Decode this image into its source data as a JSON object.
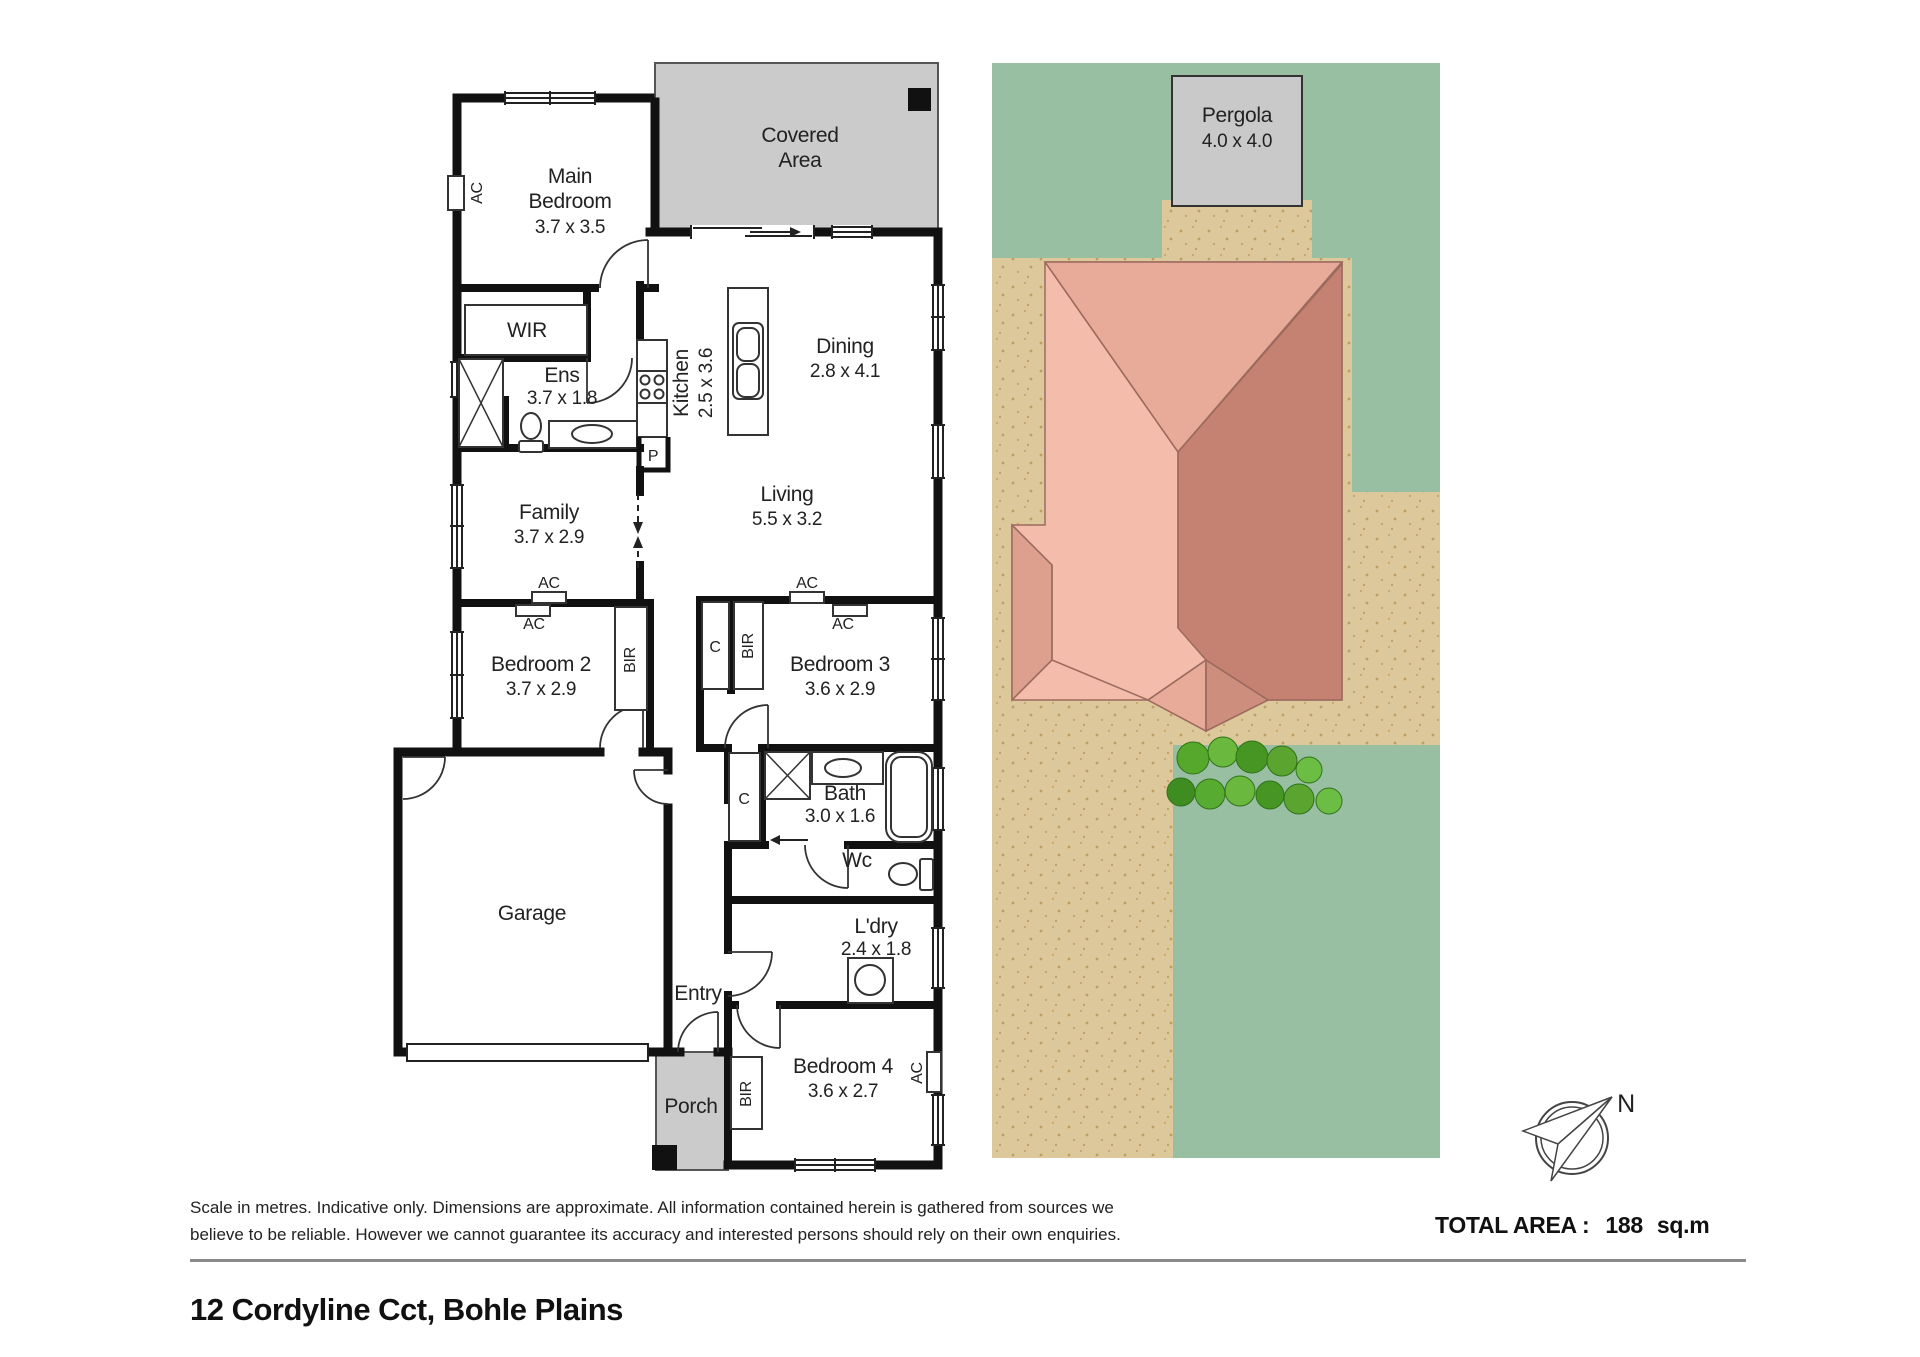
{
  "floorplan": {
    "rooms": {
      "covered_area": {
        "line1": "Covered",
        "line2": "Area"
      },
      "main_bedroom": {
        "line1": "Main",
        "line2": "Bedroom",
        "dims": "3.7 x 3.5"
      },
      "wir": {
        "label": "WIR"
      },
      "ens": {
        "label": "Ens",
        "dims": "3.7 x 1.8"
      },
      "kitchen": {
        "label": "Kitchen",
        "dims": "2.5 x 3.6"
      },
      "dining": {
        "label": "Dining",
        "dims": "2.8 x 4.1"
      },
      "living": {
        "label": "Living",
        "dims": "5.5 x 3.2"
      },
      "family": {
        "label": "Family",
        "dims": "3.7 x 2.9"
      },
      "bedroom2": {
        "label": "Bedroom 2",
        "dims": "3.7 x 2.9"
      },
      "bedroom3": {
        "label": "Bedroom 3",
        "dims": "3.6 x 2.9"
      },
      "bath": {
        "label": "Bath",
        "dims": "3.0 x 1.6"
      },
      "wc": {
        "label": "Wc"
      },
      "laundry": {
        "label": "L'dry",
        "dims": "2.4 x 1.8"
      },
      "bedroom4": {
        "label": "Bedroom 4",
        "dims": "3.6 x 2.7"
      },
      "garage": {
        "label": "Garage"
      },
      "entry": {
        "label": "Entry"
      },
      "porch": {
        "label": "Porch"
      }
    },
    "fixture_labels": {
      "ac": "AC",
      "bir": "BIR",
      "cupboard": "C",
      "pantry": "P"
    }
  },
  "siteplan": {
    "pergola": {
      "label": "Pergola",
      "dims": "4.0 x 4.0"
    },
    "compass_north": "N"
  },
  "footer": {
    "disclaimer_line1": "Scale in metres. Indicative only. Dimensions are approximate. All information contained herein is gathered from sources we",
    "disclaimer_line2": "believe to be reliable. However we cannot guarantee its accuracy and interested persons should rely on their own enquiries.",
    "total_area_label": "TOTAL AREA :",
    "total_area_value": "188",
    "total_area_unit": "sq.m",
    "address": "12 Cordyline Cct, Bohle Plains"
  },
  "colors": {
    "wall": "#111111",
    "covered_gray": "#cbcbcb",
    "lawn_green": "#98bfa2",
    "yard_tan": "#ddc89c",
    "roof_light": "#f3bcab",
    "roof_medium": "#dd9f8e",
    "roof_dark": "#c58272",
    "tree_green": "#55a82c"
  }
}
